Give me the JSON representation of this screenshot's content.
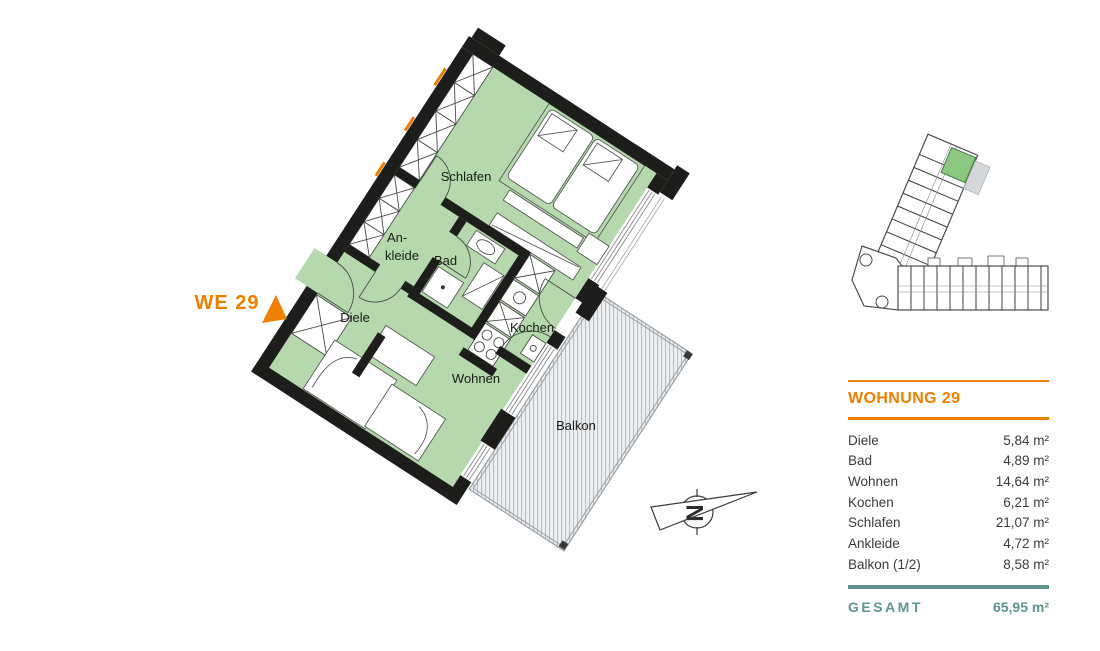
{
  "floorplan": {
    "unit_callout": "WE 29",
    "rooms": {
      "schlafen": "Schlafen",
      "ankleide_line1": "An-",
      "ankleide_line2": "kleide",
      "bad": "Bad",
      "diele": "Diele",
      "kochen": "Kochen",
      "wohnen": "Wohnen",
      "balkon": "Balkon"
    },
    "compass": {
      "letter": "N"
    }
  },
  "panel": {
    "title": "WOHNUNG 29",
    "rows": [
      {
        "label": "Diele",
        "value": "5,84 m²"
      },
      {
        "label": "Bad",
        "value": "4,89 m²"
      },
      {
        "label": "Wohnen",
        "value": "14,64 m²"
      },
      {
        "label": "Kochen",
        "value": "6,21 m²"
      },
      {
        "label": "Schlafen",
        "value": "21,07 m²"
      },
      {
        "label": "Ankleide",
        "value": "4,72 m²"
      },
      {
        "label": "Balkon (1/2)",
        "value": "8,58 m²"
      }
    ],
    "total_label": "GESAMT",
    "total_value": "65,95 m²"
  },
  "colors": {
    "accent_orange": "#ee7f00",
    "teal": "#5f948f",
    "room_green": "#b5d9ac",
    "site_highlight_green": "#8cc882",
    "wall_black": "#1d1d1b"
  }
}
